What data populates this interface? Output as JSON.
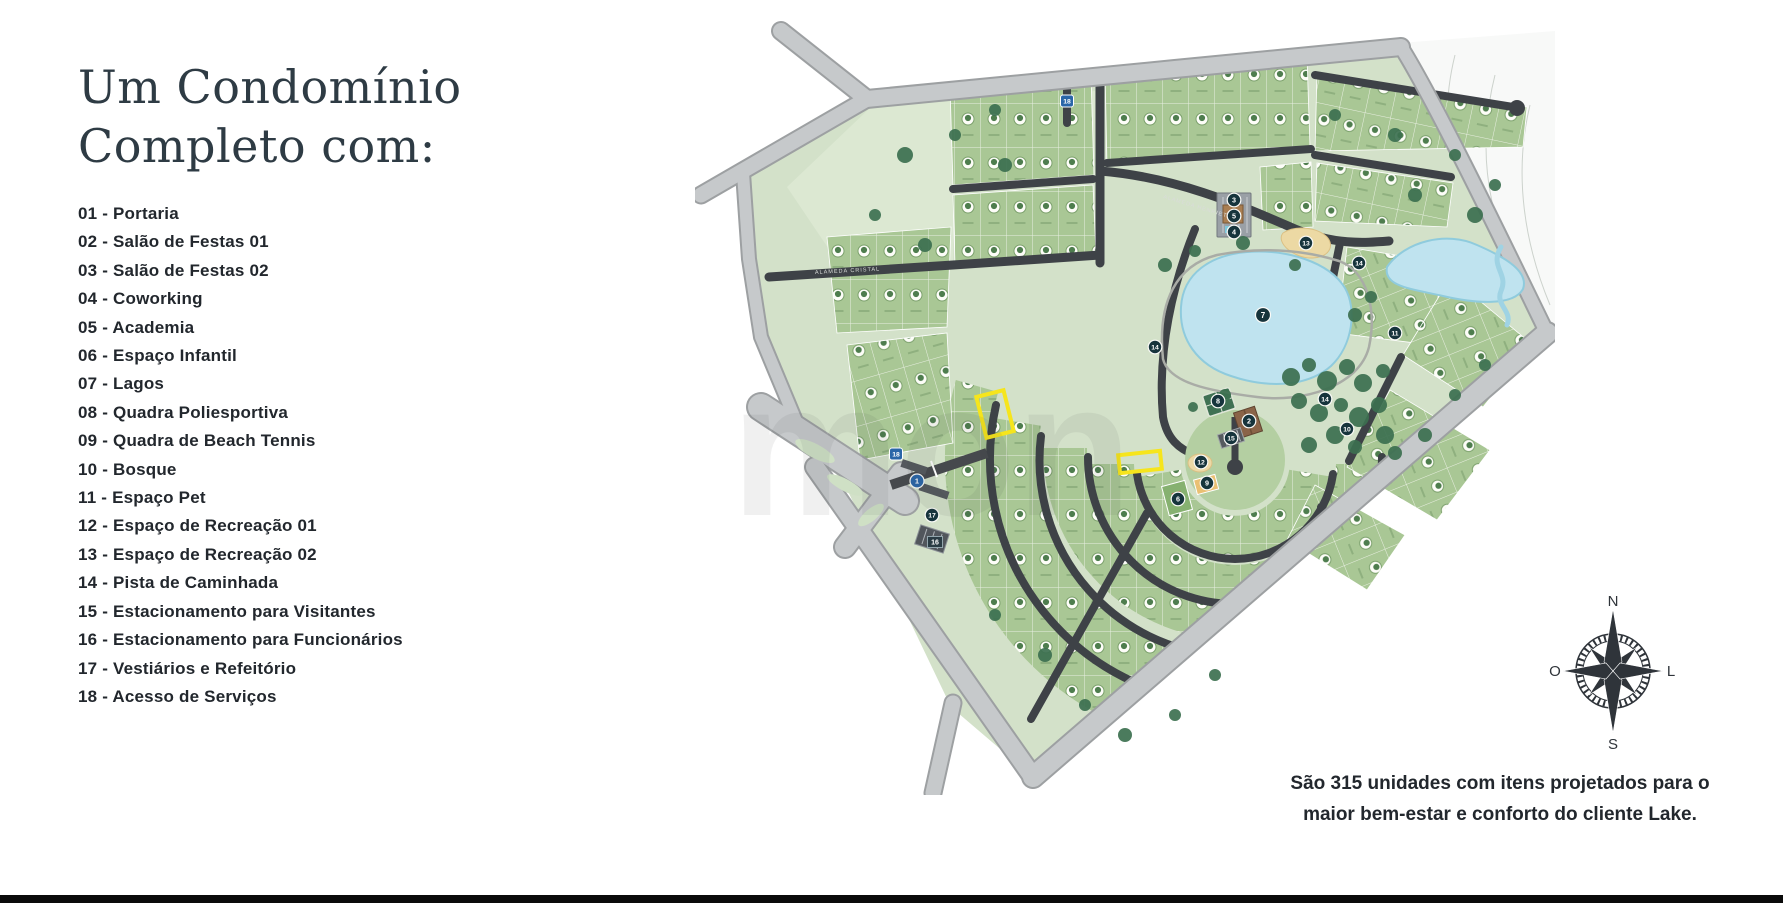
{
  "title": {
    "line1": "Um Condomínio",
    "line2": "Completo com:"
  },
  "legend": {
    "items": [
      "01 - Portaria",
      "02 - Salão de Festas 01",
      "03 - Salão de Festas 02",
      "04 - Coworking",
      "05 - Academia",
      "06 - Espaço Infantil",
      "07 - Lagos",
      "08 - Quadra Poliesportiva",
      "09 - Quadra de Beach Tennis",
      "10 - Bosque",
      "11 - Espaço Pet",
      "12 - Espaço de Recreação 01",
      "13 - Espaço de Recreação 02",
      "14 - Pista de Caminhada",
      "15 - Estacionamento para Visitantes",
      "16 - Estacionamento para Funcionários",
      "17 - Vestiários e Refeitório",
      "18 - Acesso de Serviços"
    ]
  },
  "caption": {
    "line1": "São 315 unidades com itens projetados para o",
    "line2": "maior bem-estar e conforto do cliente Lake."
  },
  "compass": {
    "north": "N",
    "south": "S",
    "west": "O",
    "east": "L"
  },
  "map": {
    "units_total": 315,
    "watermark": "mon",
    "street_labels": [
      "ALAMEDA CRISTAL",
      "ALAMEDA HENRIETTA"
    ],
    "markers": [
      {
        "n": "1"
      },
      {
        "n": "2"
      },
      {
        "n": "3"
      },
      {
        "n": "5"
      },
      {
        "n": "4"
      },
      {
        "n": "6"
      },
      {
        "n": "7"
      },
      {
        "n": "8"
      },
      {
        "n": "9"
      },
      {
        "n": "10"
      },
      {
        "n": "11"
      },
      {
        "n": "12"
      },
      {
        "n": "13"
      },
      {
        "n": "14"
      },
      {
        "n": "14"
      },
      {
        "n": "14"
      },
      {
        "n": "15"
      },
      {
        "n": "16"
      },
      {
        "n": "17"
      },
      {
        "n": "18"
      },
      {
        "n": "18"
      }
    ],
    "colors": {
      "terrain": "#d3e1c9",
      "lawn": "#dce8d2",
      "lots": "#a9c795",
      "road_dark": "#3e4247",
      "road_light": "#c6c9cb",
      "lake": "#bfe3ef",
      "sand": "#ecd9a4",
      "marker": "#16343c",
      "marker_blue": "#2a66a8",
      "highlight": "#f6e51c"
    }
  }
}
